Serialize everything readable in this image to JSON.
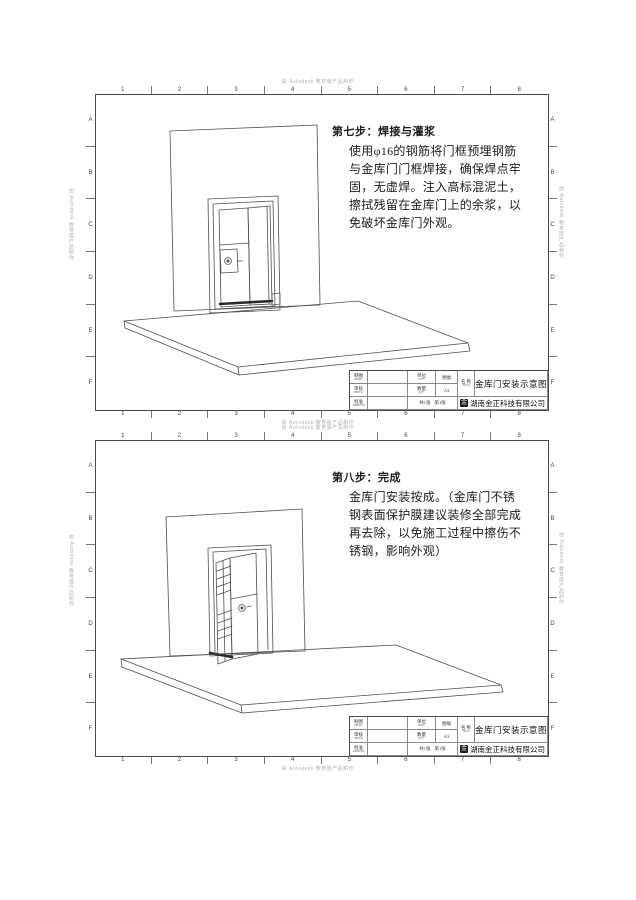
{
  "watermark": "由 Autodesk 教育版产品制作",
  "zones": {
    "cols": [
      "1",
      "2",
      "3",
      "4",
      "5",
      "6",
      "7",
      "8"
    ],
    "rows": [
      "A",
      "B",
      "C",
      "D",
      "E",
      "F"
    ]
  },
  "sheet1": {
    "step_title": "第七步：焊接与灌浆",
    "step_lines": [
      "使用φ16的钢筋将门框预埋钢筋",
      "与金库门门框焊接，确保焊点牢",
      "固，无虚焊。注入高标混泥土，",
      "擦拭残留在金库门上的余浆，以",
      "免破坏金库门外观。"
    ]
  },
  "sheet2": {
    "step_title": "第八步：完成",
    "step_lines": [
      "金库门安装按成。（金库门不锈",
      "钢表面保护膜建议装修全部完成",
      "再去除，以免施工过程中擦伤不",
      "锈钢，影响外观）"
    ]
  },
  "titleblock": {
    "draw_cn": "制图",
    "draw_en": "DRAW",
    "check_cn": "审核",
    "check_en": "CHECK",
    "approve_cn": "批准",
    "approve_en": "APPROVE",
    "unit_cn": "单位",
    "unit_en": "UNIT",
    "qty_cn": "数量",
    "qty_en": "QTY",
    "format_cn": "图幅",
    "format_value": "A3",
    "sheet_count": "共1张",
    "sheet_index": "第1张",
    "name_cn": "名 称",
    "name_en": "TITLE",
    "title": "金库门安装示意图",
    "logo_glyph": "金",
    "company": "湖南金正科技有限公司"
  }
}
